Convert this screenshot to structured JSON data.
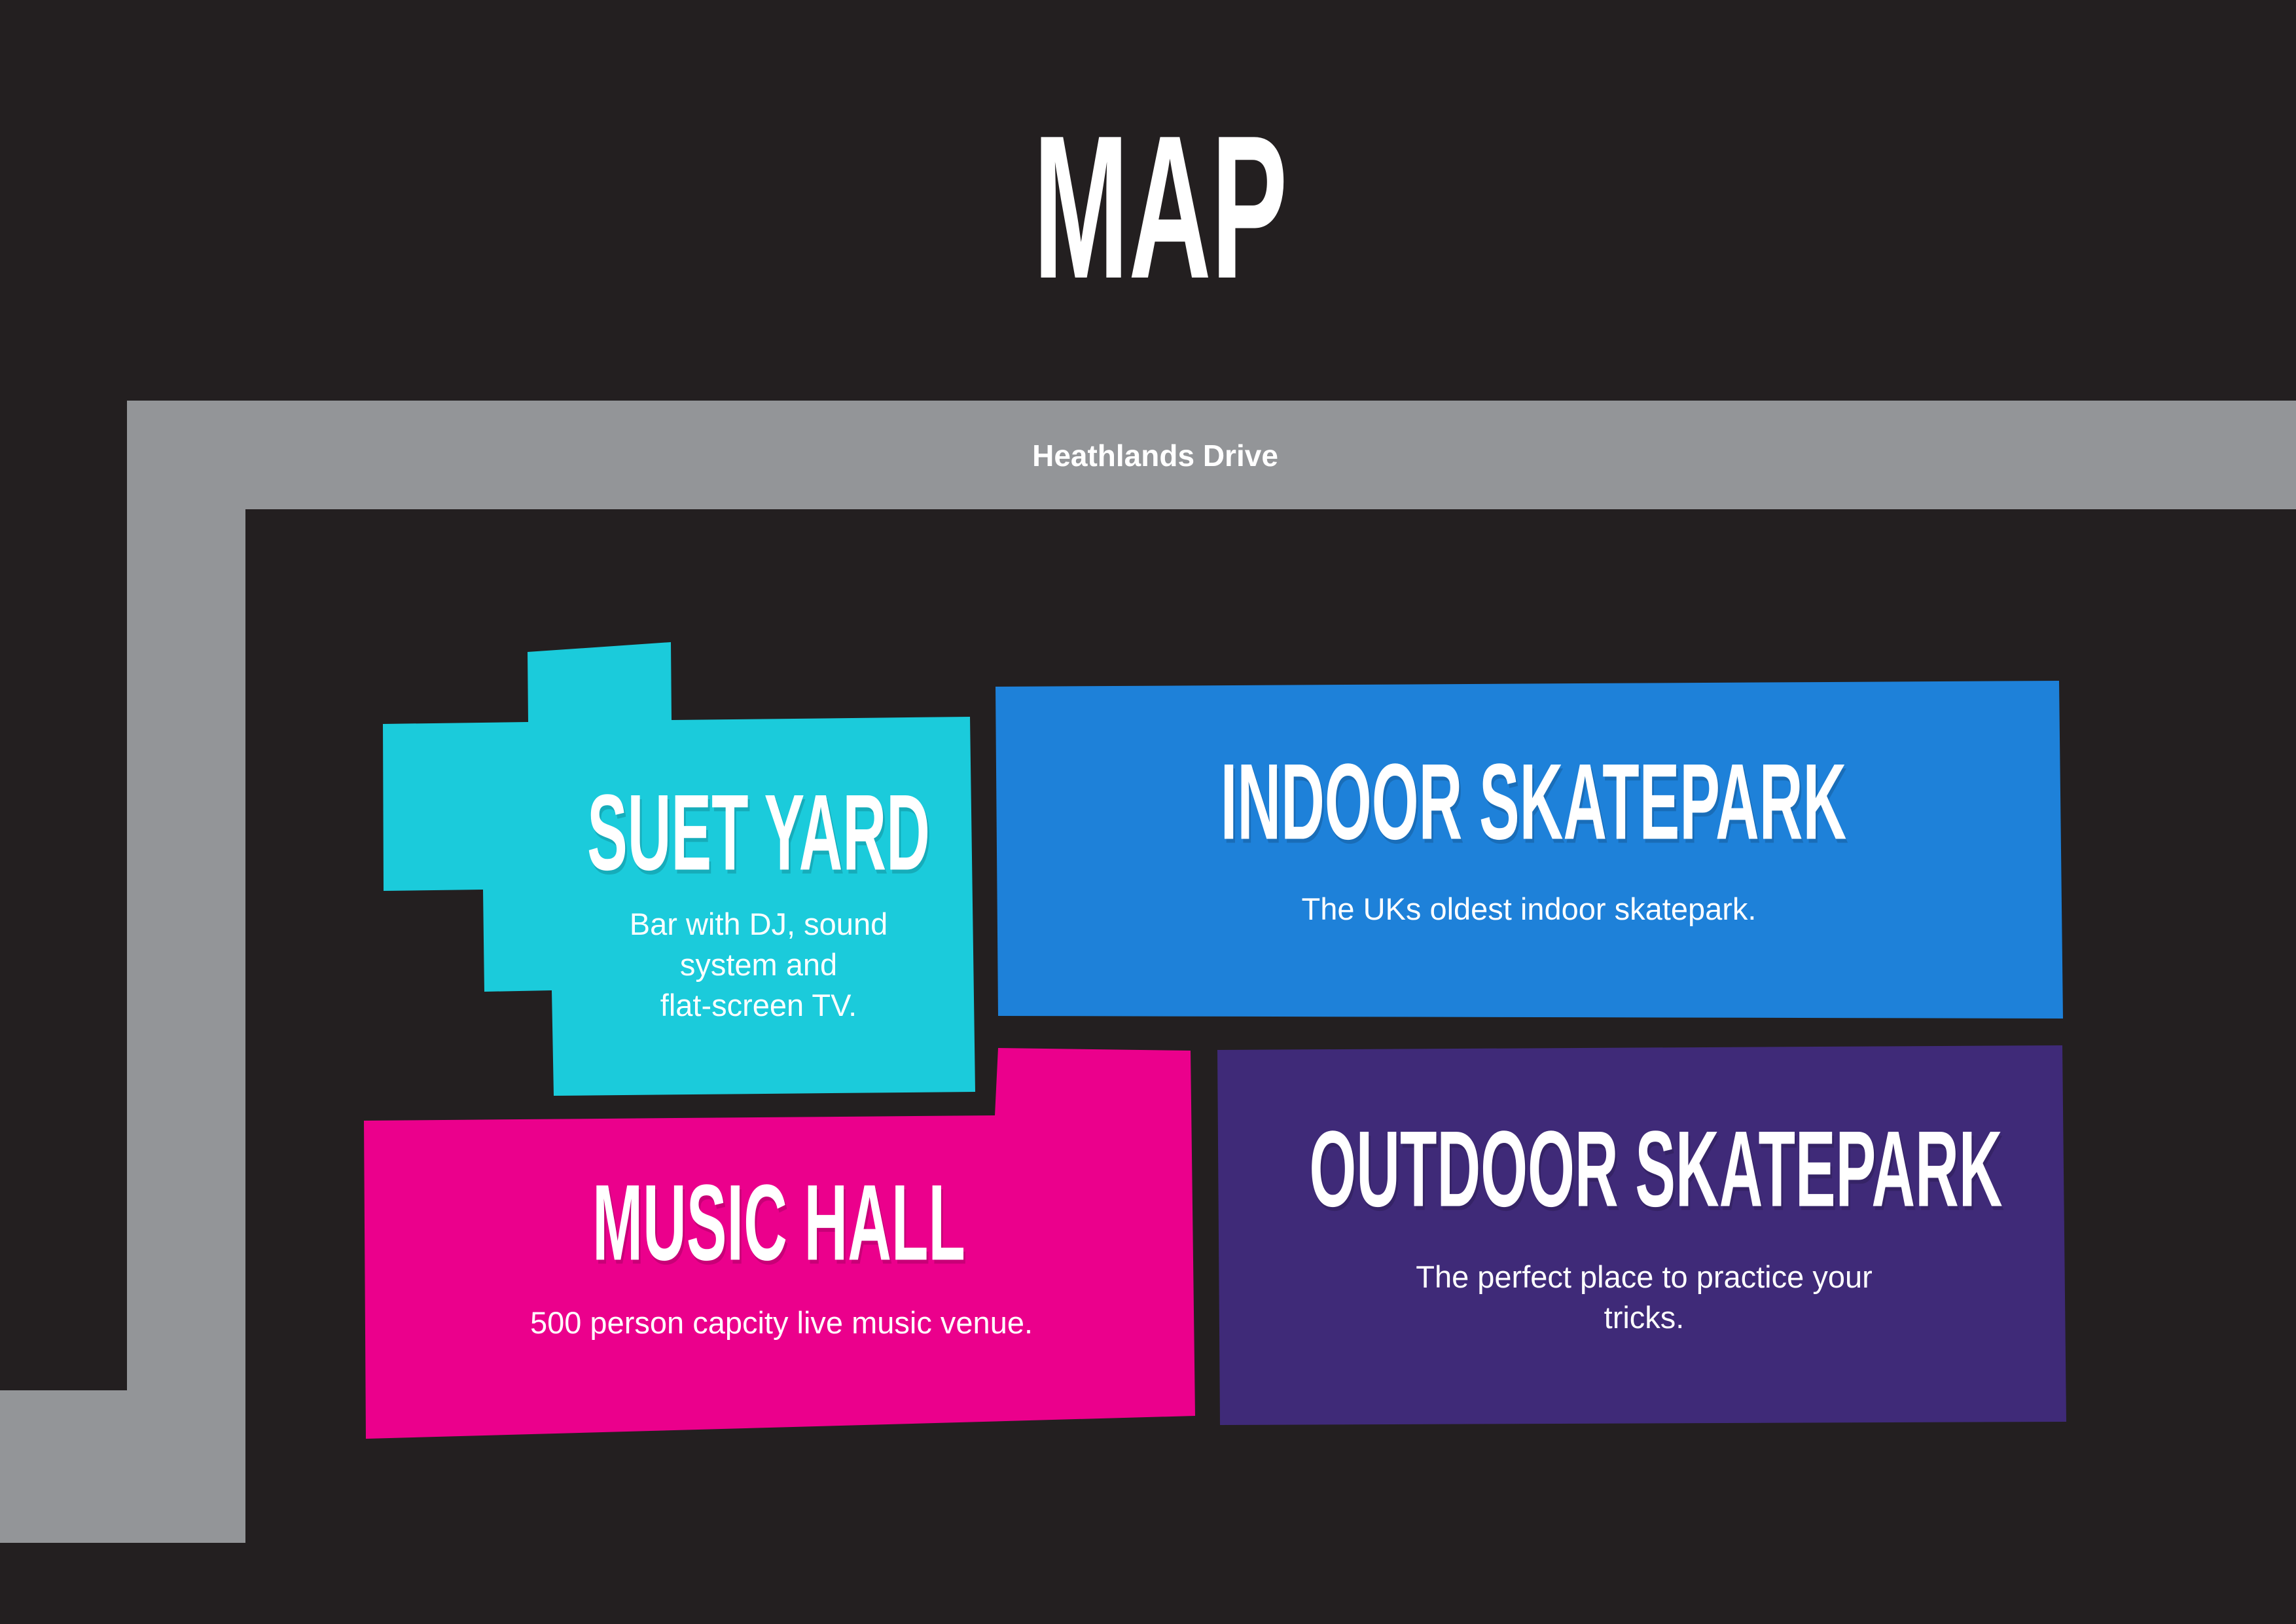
{
  "title": "MAP",
  "colors": {
    "background": "#231F20",
    "text": "#FFFFFF"
  },
  "road": {
    "name": "Heathlands Drive",
    "color": "#939598"
  },
  "venues": [
    {
      "name": "SUET YARD",
      "description_lines": [
        "Bar with DJ, sound",
        "system and",
        "flat-screen TV."
      ],
      "color": "#1BCBDB"
    },
    {
      "name": "INDOOR SKATEPARK",
      "description_lines": [
        "The UKs oldest indoor skatepark."
      ],
      "color": "#1E81D9"
    },
    {
      "name": "MUSIC HALL",
      "description_lines": [
        "500 person capcity live music venue."
      ],
      "color": "#EB008C"
    },
    {
      "name": "OUTDOOR SKATEPARK",
      "description_lines": [
        "The perfect place to practice your",
        "tricks."
      ],
      "color": "#3F2A78"
    }
  ]
}
